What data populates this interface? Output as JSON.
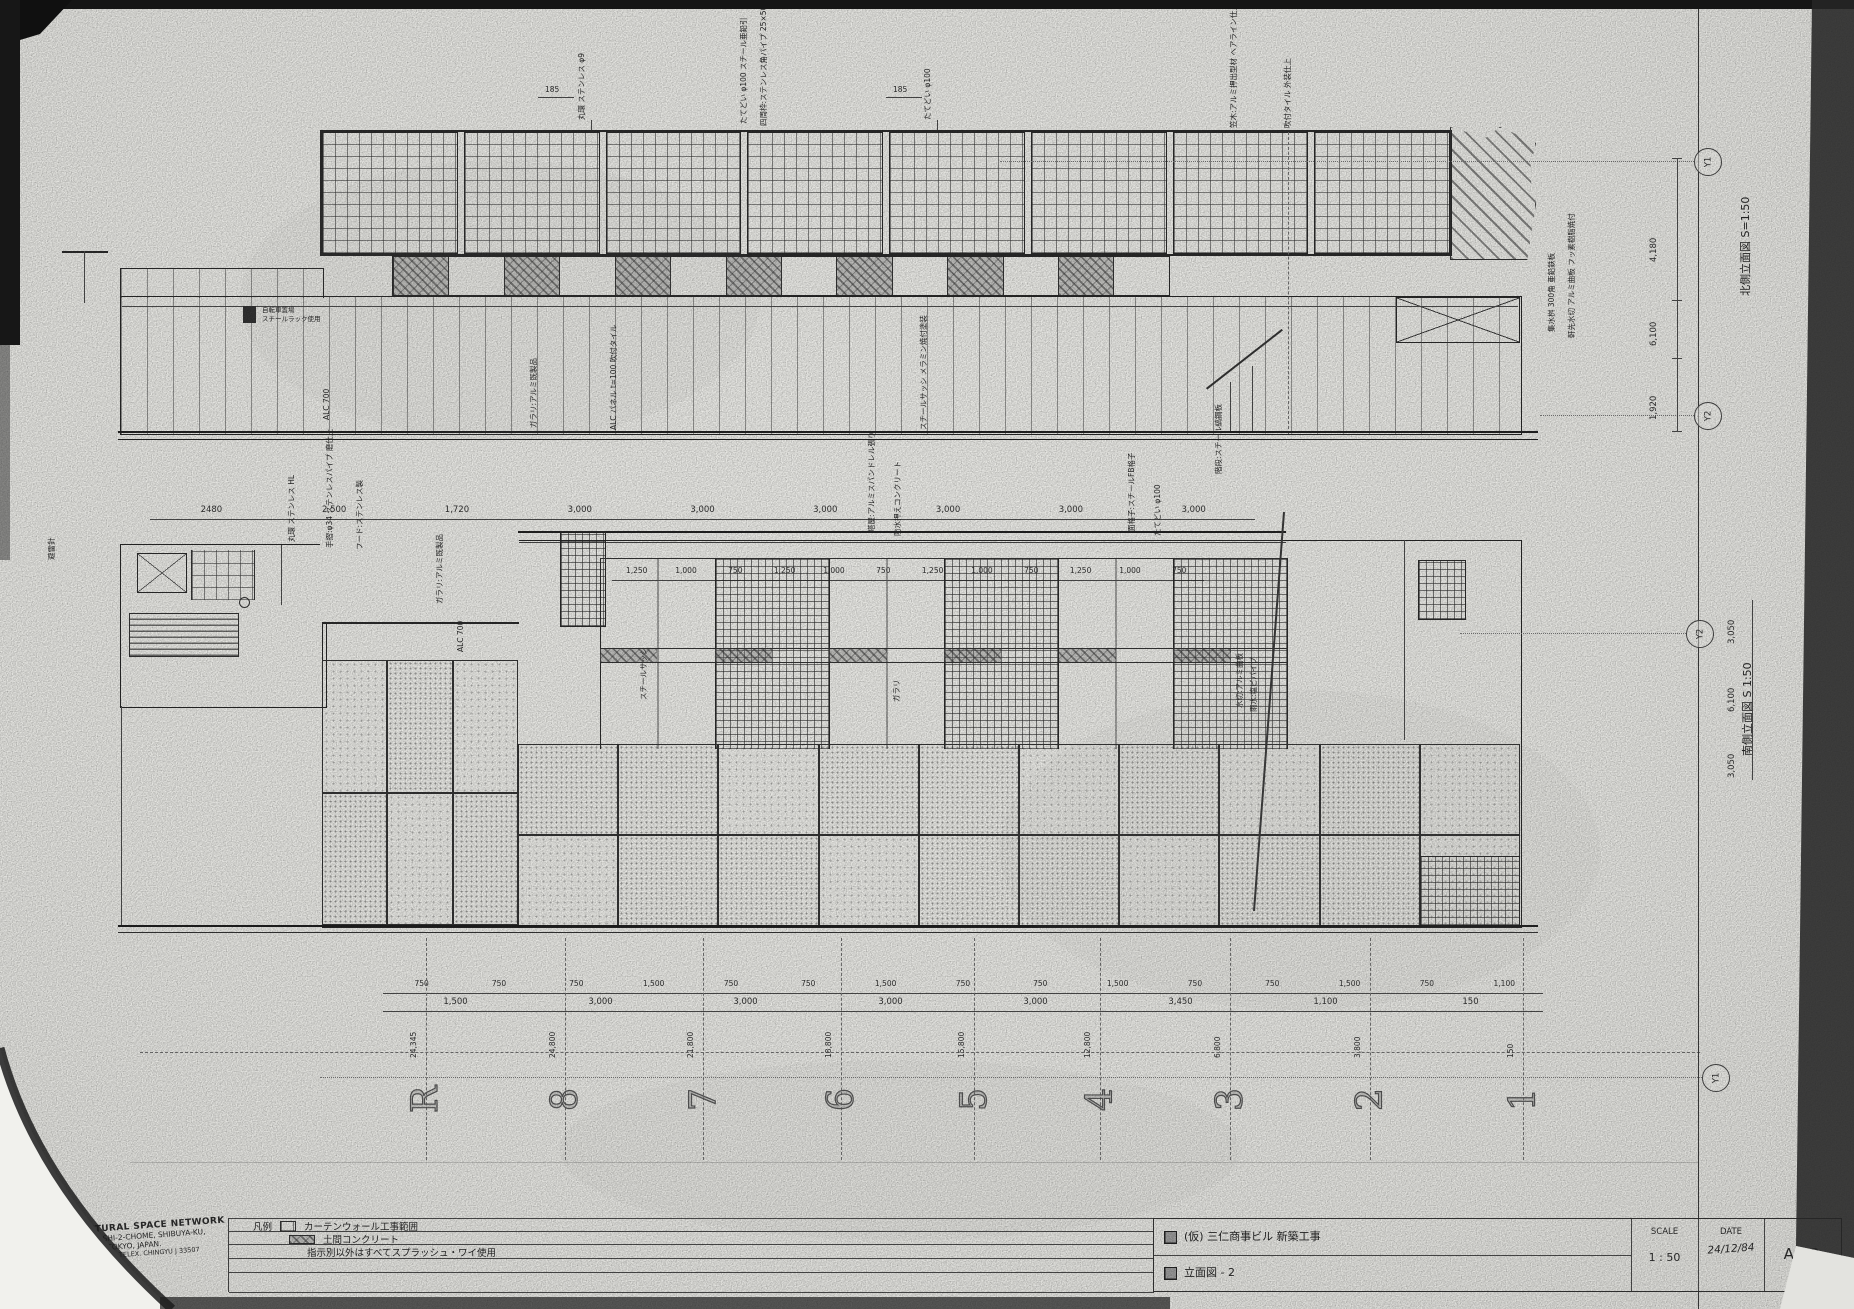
{
  "north": {
    "side_title": "北側立面図  S=1:50",
    "dims": [
      "2480",
      "2,500",
      "1,720",
      "3,000",
      "3,000",
      "3,000",
      "3,000",
      "3,000",
      "3,000"
    ],
    "top_dims": [
      "185",
      "185"
    ],
    "callouts_top": [
      "丸環 ステンレス φ9",
      "たてどい φ100 スチール亜鉛引",
      "四周枠:ステンレス角パイプ 25×50",
      "たてどい φ100",
      "笠木:アルミ押出型材 ヘアライン仕上",
      "吹付タイル 外装仕上"
    ],
    "callouts_body": [
      "ガラリ:アルミ既製品",
      "ALC パネル t=100 吹付タイル",
      "スチールサッシ メラミン焼付塗装",
      "階段:スチール縞鋼板"
    ],
    "notes": [
      "ALC 700",
      "自転車置場",
      "スチールラック使用"
    ],
    "callouts_right": [
      "集水桝 300角 亜鉛鉄板",
      "軒先水切 アルミ曲板 フッ素樹脂焼付"
    ]
  },
  "south": {
    "side_title": "南側立面図  S 1:50",
    "top_dims": [
      "1,250",
      "1,000",
      "750",
      "1,250",
      "1,000",
      "750",
      "1,250",
      "1,000",
      "750",
      "1,250",
      "1,000",
      "750"
    ],
    "dims_row1": [
      "750",
      "750",
      "750",
      "1,500",
      "750",
      "750",
      "1,500",
      "750",
      "750",
      "1,500",
      "750",
      "750",
      "1,500",
      "750",
      "1,100"
    ],
    "dims_row2": [
      "1,500",
      "3,000",
      "3,000",
      "3,000",
      "3,000",
      "3,450",
      "1,100",
      "150"
    ],
    "grid_labels": [
      "R",
      "8",
      "7",
      "6",
      "5",
      "4",
      "3",
      "2",
      "1"
    ],
    "grid_offsets": [
      "24,345",
      "24,800",
      "21,800",
      "18,800",
      "15,800",
      "12,800",
      "6,800",
      "3,800",
      "150"
    ],
    "callouts_left": [
      "避雷針",
      "丸環 ステンレス HL",
      "手摺:φ34 ステンレスパイプ 磨仕上",
      "フード:ステンレス製",
      "ガラリ:アルミ既製品"
    ],
    "callouts_top": [
      "塔屋:アルミスパンドレル張り",
      "防水押えコンクリート",
      "面格子:スチールFB格子",
      "たてどい φ100"
    ],
    "callouts_body": [
      "スチールサッシ",
      "ガラリ",
      "ALC 700"
    ],
    "callouts_right": [
      "水切:アルミ曲板",
      "雨水:塩ビパイプ"
    ]
  },
  "margin": {
    "bubbles": [
      "Y1",
      "Y2",
      "Y2",
      "Y1"
    ],
    "north_vdims": [
      "4,180",
      "6,100",
      "1,920"
    ],
    "south_vdims": [
      "3,050",
      "6,100",
      "3,050"
    ]
  },
  "titleblock": {
    "company_lines": [
      "ARCHITECTURAL  SPACE  NETWORK",
      "17-8, HIGASHI-2-CHOME,  SHIBUYA-KU,",
      "TOKYO,  JAPAN.",
      "(03) 407-8399    TELEX. CHINGYU J 33507"
    ],
    "legend_label": "凡例",
    "legend_rows": [
      "カーテンウォール工事範囲",
      "土間コンクリート",
      "指示別以外はすべてスプラッシュ・ワイ使用"
    ],
    "project": "(仮) 三仁商事ビル 新築工事",
    "sheet_title": "立面図 - 2",
    "scale_label": "SCALE",
    "scale_value": "1 : 50",
    "date_label": "DATE",
    "date_value": "24/12/84",
    "sheet_no": "A- 8"
  }
}
